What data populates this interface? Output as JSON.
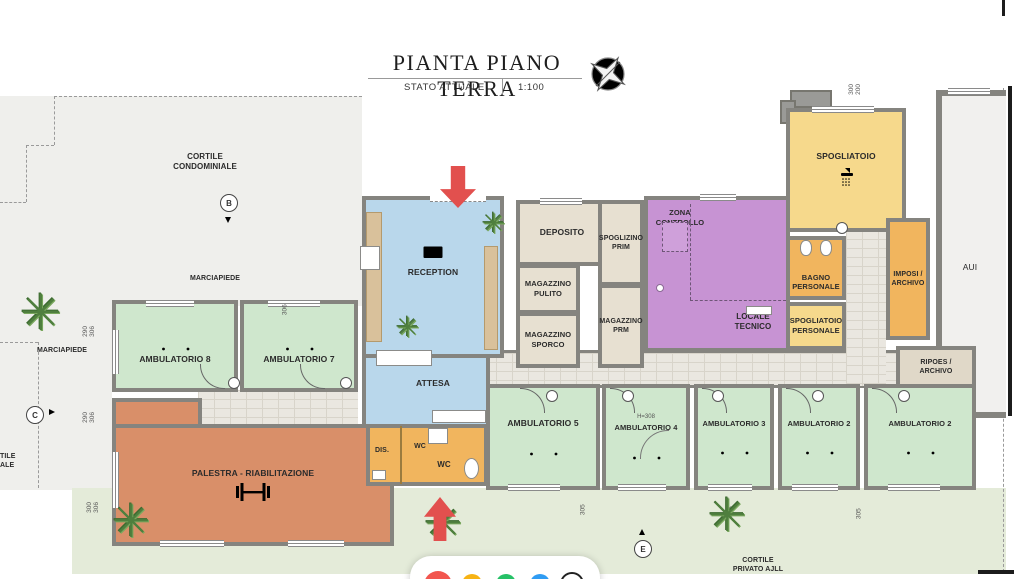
{
  "title": {
    "main": "PIANTA PIANO TERRA",
    "status": "STATO ATTUALE",
    "scale": "1:100"
  },
  "areas": {
    "cortile_condominiale": "CORTILE\nCONDOMINIALE",
    "marciapiede_top": "MARCIAPIEDE",
    "marciapiede_left": "MARCIAPIEDE",
    "cortile_privato": "CORTILE\nPRIVATO AJLL",
    "cortile_partial": "TILE\nALE",
    "aui": "AUI"
  },
  "rooms": {
    "reception": "RECEPTION",
    "attesa": "ATTESA",
    "ambulatorio8": "AMBULATORIO 8",
    "ambulatorio7": "AMBULATORIO 7",
    "palestra": "PALESTRA - RIABILITAZIONE",
    "deposito": "DEPOSITO",
    "spoglizino_prim": "SPOGLIZINO\nPRIM",
    "magazzino_pulito": "MAGAZZINO\nPULITO",
    "magazzino_sporco": "MAGAZZINO\nSPORCO",
    "magazzino_prm": "MAGAZZINO\nPRM",
    "zona_controllo": "ZONA\nCONTROLLO",
    "locale_tecnico": "LOCALE\nTECNICO",
    "spogliatoio": "SPOGLIATOIO",
    "bagno_personale": "BAGNO\nPERSONALE",
    "spogliatoio_personale": "SPOGLIATOIO\nPERSONALE",
    "imposi_archivio": "IMPOSI /\nARCHIVO",
    "ripost_archivio": "RIPOES /\nARCHIVO",
    "ambulatorio5": "AMBULATORIO 5",
    "ambulatorio4": "AMBULATORIO 4",
    "ambulatorio3": "AMBULATORIO 3",
    "ambulatorio2a": "AMBULATORIO 2",
    "ambulatorio2b": "AMBULATORIO 2",
    "wc_dis": "DIS.",
    "wc_small": "WC",
    "wc_main": "WC"
  },
  "markers": {
    "b": "B",
    "c": "C",
    "e": "E"
  },
  "dims": [
    "290\n306",
    "290\n306",
    "300\n306",
    "300\n200",
    "305",
    "305",
    "305",
    "H=308",
    "306"
  ],
  "colors": {
    "wall": "#85847f",
    "ambulatorio_green": "#cfe7cd",
    "reception_blue": "#b9d7eb",
    "storage_beige": "#e7e0d1",
    "controllo_purple": "#c793d3",
    "spogliatoio_yellow": "#f6d98c",
    "servizi_orange": "#f1b55e",
    "palestra_terracotta": "#d98f69",
    "garden_green": "#e4ebd9",
    "arrow_red": "#e2504e",
    "palette": [
      "#f2564f",
      "#f7b314",
      "#26c167",
      "#2f9cf3"
    ]
  }
}
